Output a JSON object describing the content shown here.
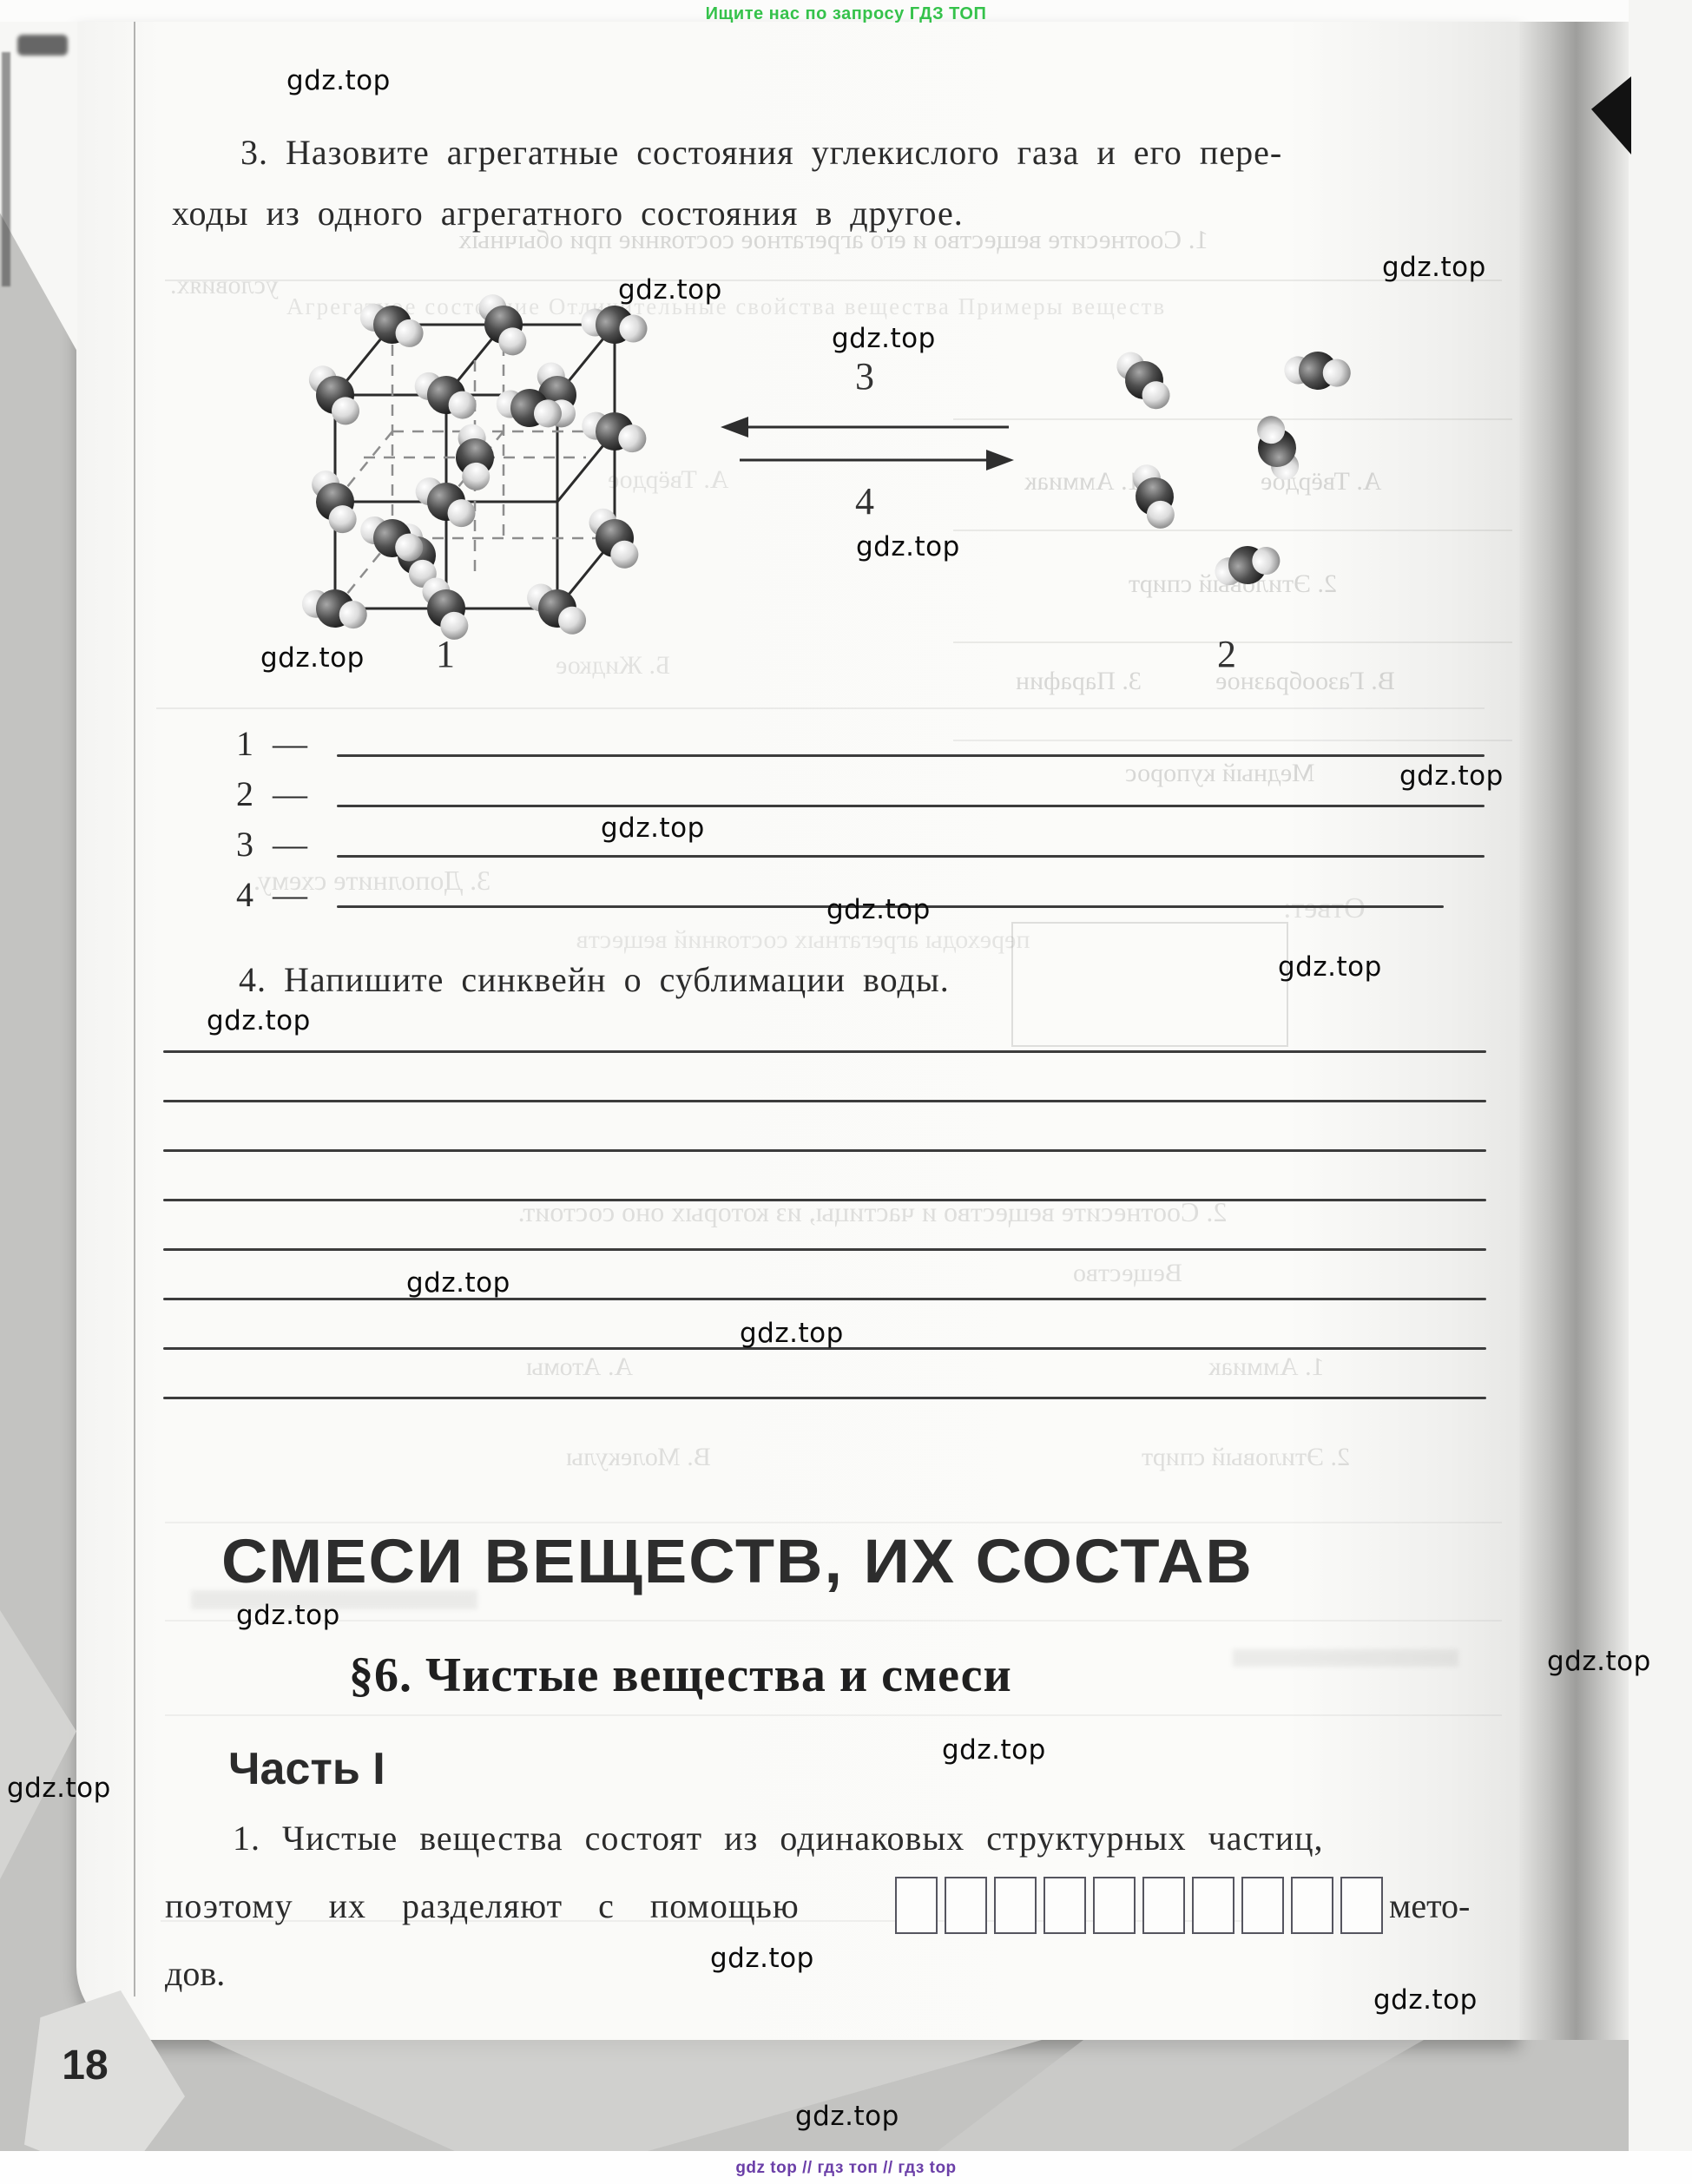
{
  "banner": {
    "text": "Ищите нас по запросу ГДЗ ТОП"
  },
  "watermark": {
    "text": "gdz.top"
  },
  "footer": {
    "text": "gdz top  //  гдз топ  //  гдз top"
  },
  "page": {
    "number": "18"
  },
  "task3": {
    "line1": "3. Назовите агрегатные состояния углекислого газа и его пере-",
    "line2": "ходы из одного агрегатного состояния в другое."
  },
  "figure": {
    "label_crystal": "1",
    "label_gas": "2",
    "label_arrow_up": "3",
    "label_arrow_down": "4"
  },
  "answers": {
    "a1": "1 —",
    "a2": "2 —",
    "a3": "3 —",
    "a4": "4 —"
  },
  "task4": {
    "text": "4. Напишите синквейн о сублимации воды."
  },
  "section": {
    "chapter": "СМЕСИ ВЕЩЕСТВ, ИХ СОСТАВ",
    "paragraph": "§6. Чистые вещества и смеси",
    "part": "Часть I"
  },
  "task1": {
    "line1": "1. Чистые вещества состоят из одинаковых структурных частиц,",
    "line2_start": "поэтому их разделяют с помощью",
    "line2_end": "мето-",
    "line3": "дов."
  },
  "bleed": {
    "top_sentence": "1. Соотнесите вещество и его агрегатное состояние при обычных",
    "top_tail": "условиях.",
    "table_header": "Агрегатное состояние        Отличительные свойства вещества        Примеры веществ",
    "r1a": "1. Аммиак",
    "r1b": "А. Твёрдое",
    "r2a": "2. Этиловый спирт",
    "r3a": "3. Парафин",
    "r3b": "В. Газообразное",
    "r4": "Медный купорос",
    "fig_solid": "А. Твёрдое",
    "fig_liquid": "Б. Жидкое",
    "scheme": "3. Дополните схему.",
    "otvet": "Ответ:",
    "transitions": "переходы агрегатных состояний веществ",
    "mid_sentence": "2. Соотнесите вещество и частицы, из которых оно состоит.",
    "substance": "Вещество",
    "atoms": "А. Атомы",
    "ammonia2": "1. Аммиак",
    "molecules": "В. Молекулы",
    "ethanol2": "2. Этиловый спирт"
  }
}
